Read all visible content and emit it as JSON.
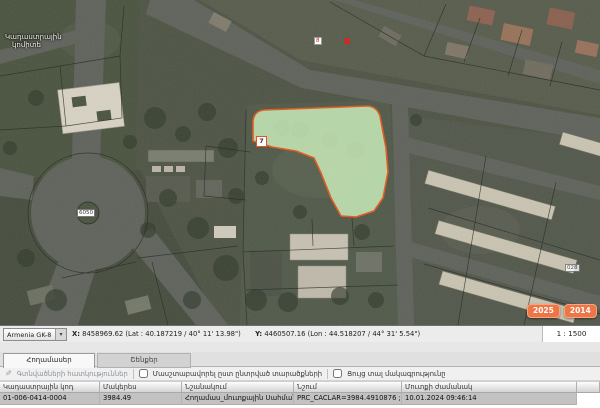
{
  "map": {
    "watermark_line1": "Կադաստրային",
    "watermark_line2": "կոմիտե",
    "parcel": {
      "label": "7",
      "fill": "#c5e8b5",
      "stroke": "#e4561b"
    },
    "labels": [
      {
        "name": "building-8",
        "text": "8"
      },
      {
        "name": "roundabout-6050",
        "text": "6050"
      },
      {
        "name": "building-028",
        "text": "028"
      }
    ],
    "year_buttons": [
      {
        "label": "2025"
      },
      {
        "label": "2014"
      },
      {
        "label": "Այլ"
      }
    ],
    "button_color": "#ee7546"
  },
  "statusbar": {
    "projection": "Armenia GK-8",
    "x_label": "X:",
    "x_value": "8458969.62 (Lat : 40.187219 / 40° 11' 13.98\")",
    "y_label": "Y:",
    "y_value": "4460507.16 (Lon : 44.518207 / 44° 31' 5.54\")",
    "scale": "1 : 1500"
  },
  "panel": {
    "tabs": [
      {
        "label": "Հողամասեր",
        "active": true
      },
      {
        "label": "Շենքեր",
        "active": false
      }
    ],
    "properties_link": "Գտնվածների հատկություններ",
    "checkbox_zoom_label": "Մասշտաբավորել ըստ ընտրված տարածքների",
    "checkbox_show_label": "Ցույց տալ մակագրությունը"
  },
  "table": {
    "columns": [
      "Կադաստրային կոդ",
      "Մակերես",
      "Նշանակում",
      "Նշում",
      "Մուտքի ժամանակ"
    ],
    "rows": [
      {
        "code": "01-006-0414-0004",
        "area": "3984.49",
        "designation": "Հողամաս_մուտքային Սահման",
        "note": "PRC_CACLAR=3984.4910876 ; PR...",
        "time": "10.01.2024 09:46:14"
      }
    ]
  }
}
